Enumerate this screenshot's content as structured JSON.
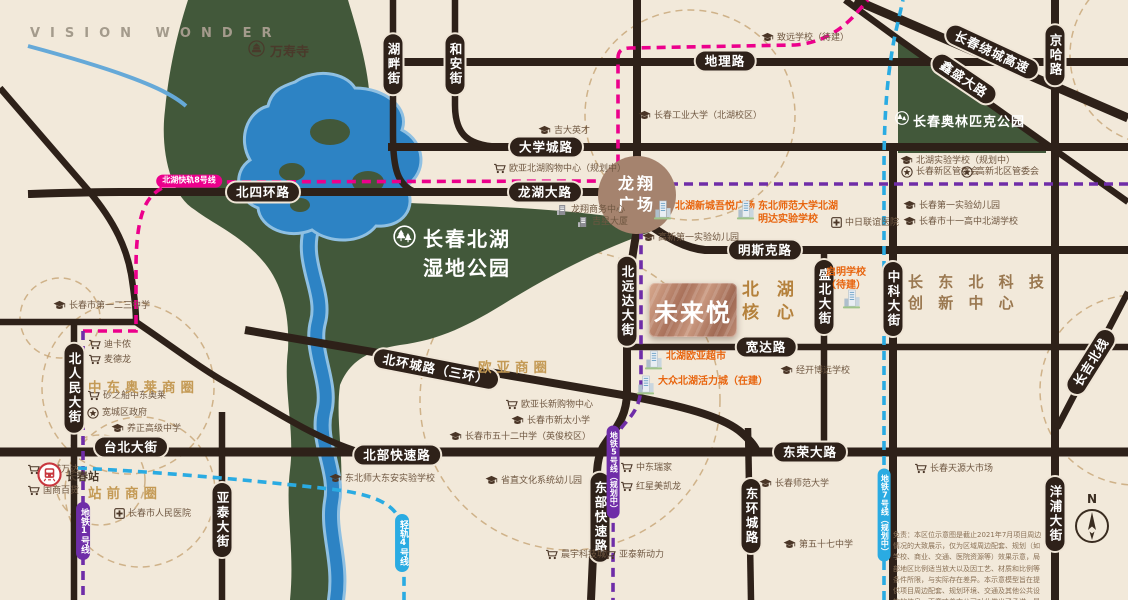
{
  "branding": {
    "tagline": "VISION WONDER"
  },
  "project": {
    "name": "未来悦"
  },
  "core_area": {
    "lines": [
      "北 湖",
      "核 心 区"
    ]
  },
  "plaza": {
    "lines": [
      "龙翔",
      "广场"
    ]
  },
  "wetland_park": {
    "lines": [
      "长春北湖",
      "湿地公园"
    ]
  },
  "olympic_park": {
    "name": "长春奥林匹克公园"
  },
  "tech_center": {
    "lines": [
      "长 东 北 科 技",
      "创 新 中 心"
    ]
  },
  "temple": {
    "name": "万寿寺"
  },
  "station": {
    "name": "长春站"
  },
  "compass": {
    "north_label": "N"
  },
  "colors": {
    "background": "#f2e9da",
    "road": "#2e2119",
    "park_green": "#42583a",
    "water_blue": "#2d83c4",
    "metro_magenta": "#ec008c",
    "metro_purple": "#6f2da8",
    "metro_cyan": "#2aabe2",
    "gold_text": "#c49a55",
    "orange_poi": "#e8650f",
    "bronze_plaque": "#a9715a",
    "plaza_brown": "#a5836e"
  },
  "business_circles": [
    {
      "name": "欧亚商圈",
      "x": 478,
      "y": 356
    },
    {
      "name": "中东奥莱商圈",
      "x": 88,
      "y": 376
    },
    {
      "name": "站前商圈",
      "x": 88,
      "y": 482
    }
  ],
  "road_labels": [
    {
      "label": "湖畔街",
      "x": 393,
      "y": 64,
      "v": 1
    },
    {
      "label": "和安街",
      "x": 455,
      "y": 64,
      "v": 1
    },
    {
      "label": "地理路",
      "x": 725,
      "y": 61
    },
    {
      "label": "大学城路",
      "x": 546,
      "y": 147
    },
    {
      "label": "北四环路",
      "x": 263,
      "y": 192
    },
    {
      "label": "龙湖大路",
      "x": 545,
      "y": 192
    },
    {
      "label": "明斯克路",
      "x": 765,
      "y": 250
    },
    {
      "label": "宽达路",
      "x": 766,
      "y": 347
    },
    {
      "label": "北环城路（三环）",
      "x": 436,
      "y": 369,
      "rot": 11
    },
    {
      "label": "台北大街",
      "x": 131,
      "y": 447
    },
    {
      "label": "北部快速路",
      "x": 397,
      "y": 455
    },
    {
      "label": "东荣大路",
      "x": 810,
      "y": 452
    },
    {
      "label": "北远达大街",
      "x": 627,
      "y": 301,
      "v": 1
    },
    {
      "label": "盛北大街",
      "x": 824,
      "y": 297,
      "v": 1
    },
    {
      "label": "中科大街",
      "x": 893,
      "y": 299,
      "v": 1
    },
    {
      "label": "北人民大街",
      "x": 74,
      "y": 388,
      "v": 1
    },
    {
      "label": "亚泰大街",
      "x": 222,
      "y": 520,
      "v": 1
    },
    {
      "label": "东部快速路",
      "x": 600,
      "y": 517,
      "v": 1
    },
    {
      "label": "东环城路",
      "x": 751,
      "y": 516,
      "v": 1
    },
    {
      "label": "洋浦大街",
      "x": 1055,
      "y": 514,
      "v": 1
    },
    {
      "label": "京哈路",
      "x": 1055,
      "y": 55,
      "v": 1
    },
    {
      "label": "长春绕城高速",
      "x": 992,
      "y": 52,
      "rot": 25
    },
    {
      "label": "鑫盛大路",
      "x": 964,
      "y": 79,
      "rot": 34
    },
    {
      "label": "长吉北线",
      "x": 1091,
      "y": 362,
      "rot": -58
    }
  ],
  "metro_labels": [
    {
      "label": "北湖快轨8号线",
      "x": 189,
      "y": 181,
      "color": "#ec008c",
      "small": 1
    },
    {
      "label": "地铁1号线",
      "x": 83,
      "y": 531,
      "color": "#6f2da8",
      "v": 1
    },
    {
      "label": "地铁5号线（规划中）",
      "x": 613,
      "y": 472,
      "color": "#6f2da8",
      "v": 1,
      "small": 1
    },
    {
      "label": "轻轨4号线",
      "x": 402,
      "y": 543,
      "color": "#2aabe2",
      "v": 1
    },
    {
      "label": "地铁7号线（规划中）",
      "x": 884,
      "y": 515,
      "color": "#2aabe2",
      "v": 1,
      "small": 1
    }
  ],
  "pois": [
    {
      "t": "school",
      "label": "吉大英才",
      "x": 538,
      "y": 126
    },
    {
      "t": "school",
      "label": "长春工业大学（北湖校区）",
      "x": 638,
      "y": 111
    },
    {
      "t": "cart",
      "label": "欧亚北湖购物中心（规划中）",
      "x": 493,
      "y": 164
    },
    {
      "t": "bgray",
      "label": "龙翔商务中心",
      "x": 556,
      "y": 205
    },
    {
      "t": "bgray",
      "label": "吉星大厦",
      "x": 577,
      "y": 217
    },
    {
      "t": "school",
      "label": "致远学校（待建）",
      "x": 761,
      "y": 33
    },
    {
      "t": "school",
      "label": "北湖实验学校（规划中）",
      "x": 900,
      "y": 156
    },
    {
      "t": "star",
      "label": "长春新区管委会",
      "x": 901,
      "y": 167
    },
    {
      "t": "star",
      "label": "高新北区管委会",
      "x": 961,
      "y": 167
    },
    {
      "t": "school",
      "label": "长春第一实验幼儿园",
      "x": 903,
      "y": 201
    },
    {
      "t": "school",
      "label": "长春市十一高中北湖学校",
      "x": 903,
      "y": 217
    },
    {
      "t": "hospital",
      "label": "中日联谊医院",
      "x": 831,
      "y": 218
    },
    {
      "t": "school",
      "label": "高新第一实验幼儿园",
      "x": 642,
      "y": 233
    },
    {
      "t": "school",
      "label": "经开博远学校",
      "x": 780,
      "y": 366
    },
    {
      "t": "school",
      "label": "长春市第一二三中学",
      "x": 53,
      "y": 301
    },
    {
      "t": "cart",
      "label": "迪卡侬",
      "x": 88,
      "y": 340
    },
    {
      "t": "cart",
      "label": "麦德龙",
      "x": 88,
      "y": 355
    },
    {
      "t": "cart",
      "label": "砂之船中东奥莱",
      "x": 87,
      "y": 391
    },
    {
      "t": "star",
      "label": "宽城区政府",
      "x": 87,
      "y": 408
    },
    {
      "t": "school",
      "label": "养正高级中学",
      "x": 111,
      "y": 424
    },
    {
      "t": "cart",
      "label": "欧亚长新购物中心",
      "x": 505,
      "y": 400
    },
    {
      "t": "school",
      "label": "长春市新太小学",
      "x": 511,
      "y": 416
    },
    {
      "t": "school",
      "label": "长春市五十二中学（英俊校区）",
      "x": 449,
      "y": 432
    },
    {
      "t": "school",
      "label": "东北师大东安实验学校",
      "x": 329,
      "y": 474
    },
    {
      "t": "school",
      "label": "省直文化系统幼儿园",
      "x": 485,
      "y": 476
    },
    {
      "t": "cart",
      "label": "晨宇科技城",
      "x": 545,
      "y": 550
    },
    {
      "t": "cart",
      "label": "亚泰新动力",
      "x": 603,
      "y": 550
    },
    {
      "t": "cart",
      "label": "中东瑞家",
      "x": 620,
      "y": 463
    },
    {
      "t": "cart",
      "label": "红星美凯龙",
      "x": 620,
      "y": 482
    },
    {
      "t": "school",
      "label": "长春师范大学",
      "x": 759,
      "y": 479
    },
    {
      "t": "school",
      "label": "第五十七中学",
      "x": 783,
      "y": 540
    },
    {
      "t": "cart",
      "label": "长春天源大市场",
      "x": 914,
      "y": 464
    },
    {
      "t": "cart",
      "label": "宽城万达",
      "x": 27,
      "y": 465
    },
    {
      "t": "cart",
      "label": "国商百货",
      "x": 27,
      "y": 486
    },
    {
      "t": "hospital",
      "label": "长春市人民医院",
      "x": 114,
      "y": 509
    },
    {
      "t": "building",
      "label": "北湖新城吾悦广场",
      "x": 653,
      "y": 200,
      "o": 1
    },
    {
      "t": "building",
      "lines": [
        "东北师范大学北湖",
        "明达实验学校"
      ],
      "x": 736,
      "y": 200,
      "o": 1
    },
    {
      "t": "none",
      "lines": [
        "启明学校",
        "（待建）"
      ],
      "x": 830,
      "y": 266,
      "o": 1,
      "center": 1
    },
    {
      "t": "building",
      "label": "北湖欧亚超市",
      "x": 644,
      "y": 350,
      "o": 1
    },
    {
      "t": "building",
      "label": "大众北湖活力城（在建）",
      "x": 636,
      "y": 375,
      "o": 1
    }
  ],
  "standalone_building_icons": [
    {
      "x": 842,
      "y": 288
    }
  ],
  "disclaimer": "免责：本区位示意图是截止2021年7月项目周边情况的大致展示，仅为区域周边配套、规划（如学校、商业、交通、医院资源等）效果示意，局部地区比例适当放大以及因工艺、材质和比例等条件所限，与实际存在差异。本示意模型旨在提供项目周边配套、规划环境、交通及其他公共设施的信息，不意味着本公司对此做出了承诺，最终以政府的最终规划方案为准。"
}
